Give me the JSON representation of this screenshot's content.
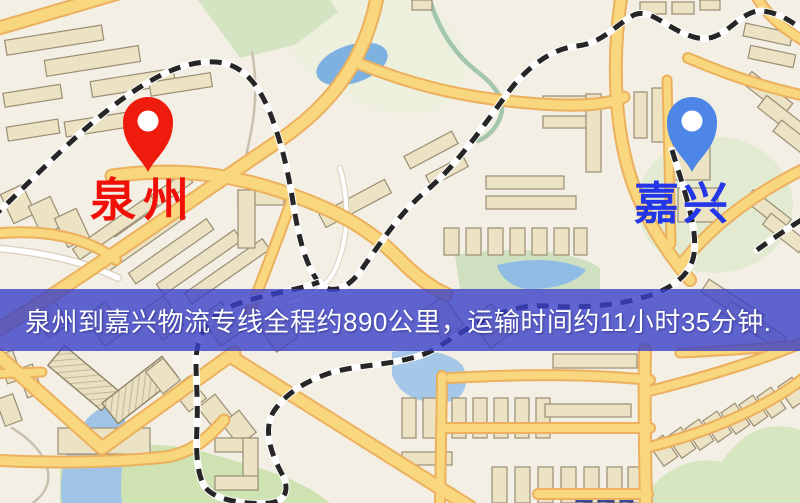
{
  "map": {
    "origin": {
      "label": "泉州",
      "pin_icon": "red-location-pin",
      "pin_color": "#ef1c0d",
      "label_color": "#f01008"
    },
    "destination": {
      "label": "嘉兴",
      "pin_icon": "blue-location-pin",
      "pin_color": "#4e86e8",
      "label_color": "#2336e8"
    },
    "colors": {
      "background": "#f3efe4",
      "road_fill": "#f8d77e",
      "road_casing": "#ecb05e",
      "building": "#ece2c4",
      "water": "#85b3df",
      "park": "#d5e5c2",
      "railway": "#262626"
    }
  },
  "banner": {
    "text": "泉州到嘉兴物流专线全程约890公里，运输时间约11小时35分钟.",
    "background_color": "rgba(58,64,200,0.80)",
    "text_color": "#ffffff"
  },
  "route_info": {
    "origin_city": "泉州",
    "destination_city": "嘉兴",
    "distance_km": "890",
    "duration": "11小时35分钟"
  }
}
